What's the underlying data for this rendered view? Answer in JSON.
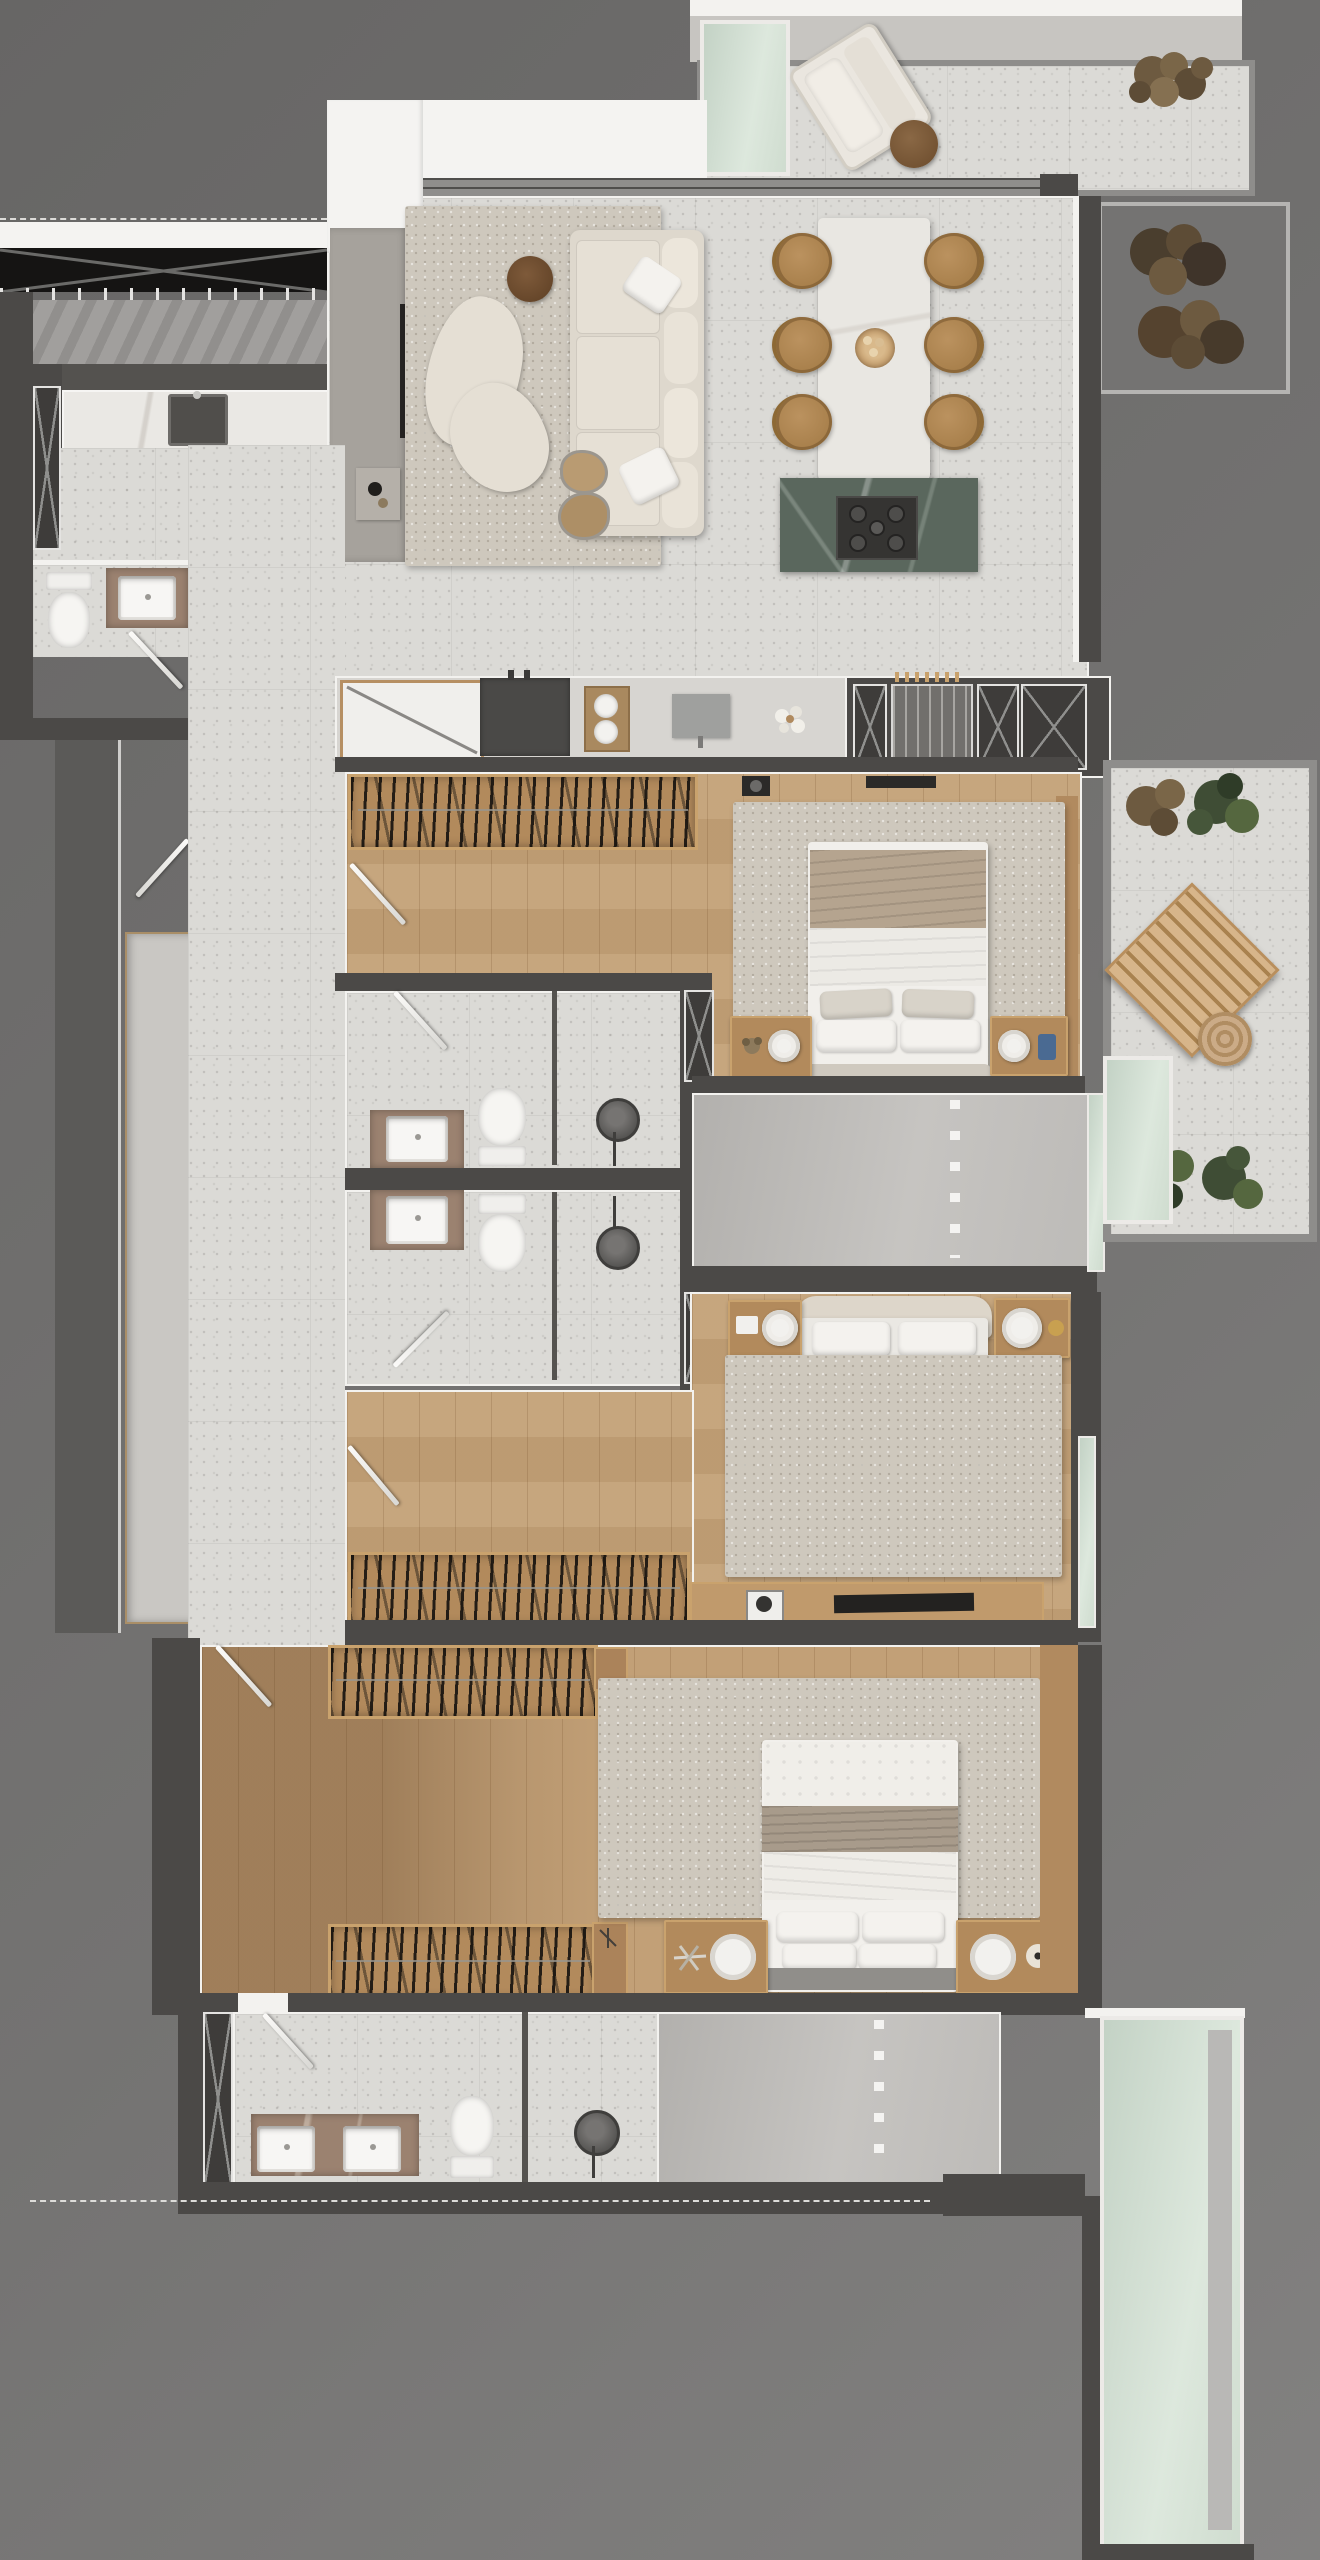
{
  "document_title": "apartment-floor-plan-top-view",
  "palette": {
    "backdrop1": "#676665",
    "backdrop2": "#747372",
    "backdrop3": "#828180",
    "wall": "#4b4947",
    "trim": "#f3f2ef",
    "terrazzo": "#dbdad6",
    "wood": "#c2a077",
    "wood_trim": "#c9a26d",
    "rug": "#cec8bd",
    "cream": "#ded8cd",
    "white": "#f4f3f1",
    "mint": "#ccd9cd",
    "island_green": "#5a675d",
    "tan": "#b28a5c",
    "blanket_brown": "#b28b63",
    "throw_taupe": "#b5a48f",
    "chair_tan": "#ae854f",
    "side_brown": "#6f4b2e",
    "plant_green": "#55673f",
    "plant_dark": "#3c4a34",
    "plant_brown": "#7a6648",
    "vanity_marble": "#9b8270",
    "slab": "#c9c7c3",
    "black": "#151413"
  },
  "legend": {
    "door_marker": "door-leaf",
    "shaft_marker": "x-brace-duct",
    "projection_marker": "dashed-projection-line",
    "clothes_marker": "hanger-row"
  },
  "rooms": [
    {
      "name": "upper-terrace",
      "floor": "terrazzo",
      "furniture": [
        "lounge-chair",
        "ottoman",
        "glass-skylight",
        "planting"
      ]
    },
    {
      "name": "living-room",
      "floor": "terrazzo",
      "furniture": [
        "area-rug",
        "sofa",
        "organic-coffee-tables",
        "round-side-table",
        "media-wall",
        "wall-tv",
        "console-table",
        "decor-objects"
      ]
    },
    {
      "name": "dining-area",
      "floor": "terrazzo",
      "furniture": [
        "stone-dining-table",
        "six-round-chairs",
        "centerpiece-bowl"
      ]
    },
    {
      "name": "kitchen",
      "floor": "terrazzo",
      "furniture": [
        "green-marble-island",
        "five-burner-cooktop",
        "counter-board",
        "range-cabinet",
        "serving-tray",
        "prep-board",
        "flower-decor"
      ]
    },
    {
      "name": "service-core",
      "floor": "none",
      "furniture": [
        "x-brace-shafts",
        "pantry-recess"
      ]
    },
    {
      "name": "entry-foyer",
      "floor": "terrazzo",
      "furniture": [
        "pergola-canopy",
        "louver-shade",
        "breakfast-counter",
        "counter-sink",
        "x-brace-storage-door"
      ]
    },
    {
      "name": "powder-room",
      "floor": "terrazzo",
      "furniture": [
        "toilet",
        "washbasin-vanity"
      ]
    },
    {
      "name": "side-court",
      "floor": "concrete",
      "furniture": [
        "bench-slab"
      ]
    },
    {
      "name": "suite-1-bedroom",
      "floor": "wood",
      "furniture": [
        "hanging-closet",
        "double-bed",
        "two-nightstands",
        "speakers",
        "bedroom-rug",
        "tv-shelf"
      ]
    },
    {
      "name": "suite-1-balcony",
      "floor": "terrazzo",
      "furniture": [
        "slatted-lounger",
        "garden-pouf",
        "planting-north",
        "planting-south",
        "glass-guard"
      ]
    },
    {
      "name": "bathroom-1",
      "floor": "terrazzo",
      "furniture": [
        "washbasin-vanity",
        "toilet",
        "rain-shower",
        "glass-partition"
      ]
    },
    {
      "name": "bathroom-2",
      "floor": "terrazzo",
      "furniture": [
        "washbasin-vanity",
        "toilet",
        "rain-shower",
        "glass-partition"
      ]
    },
    {
      "name": "multipurpose-room-1",
      "floor": "screed",
      "furniture": [
        "dashed-projection-line"
      ]
    },
    {
      "name": "suite-2-bedroom",
      "floor": "wood",
      "furniture": [
        "double-bed-brown-blanket",
        "two-nightstands",
        "speakers",
        "bedroom-rug",
        "tv-dresser",
        "hanging-closet"
      ]
    },
    {
      "name": "master-suite",
      "floor": "wood",
      "furniture": [
        "hanging-closet-north",
        "hanging-closet-south",
        "dressers",
        "double-bed",
        "two-nightstands",
        "round-trays",
        "bedroom-rug"
      ]
    },
    {
      "name": "master-bathroom",
      "floor": "terrazzo",
      "furniture": [
        "double-washbasin-vanity",
        "toilet",
        "rain-shower",
        "glass-partition",
        "x-brace-shaft"
      ]
    },
    {
      "name": "multipurpose-room-2",
      "floor": "screed",
      "furniture": [
        "dashed-projection-line"
      ]
    },
    {
      "name": "winter-garden",
      "floor": "glass",
      "furniture": [
        "glass-floor-panel"
      ]
    }
  ]
}
